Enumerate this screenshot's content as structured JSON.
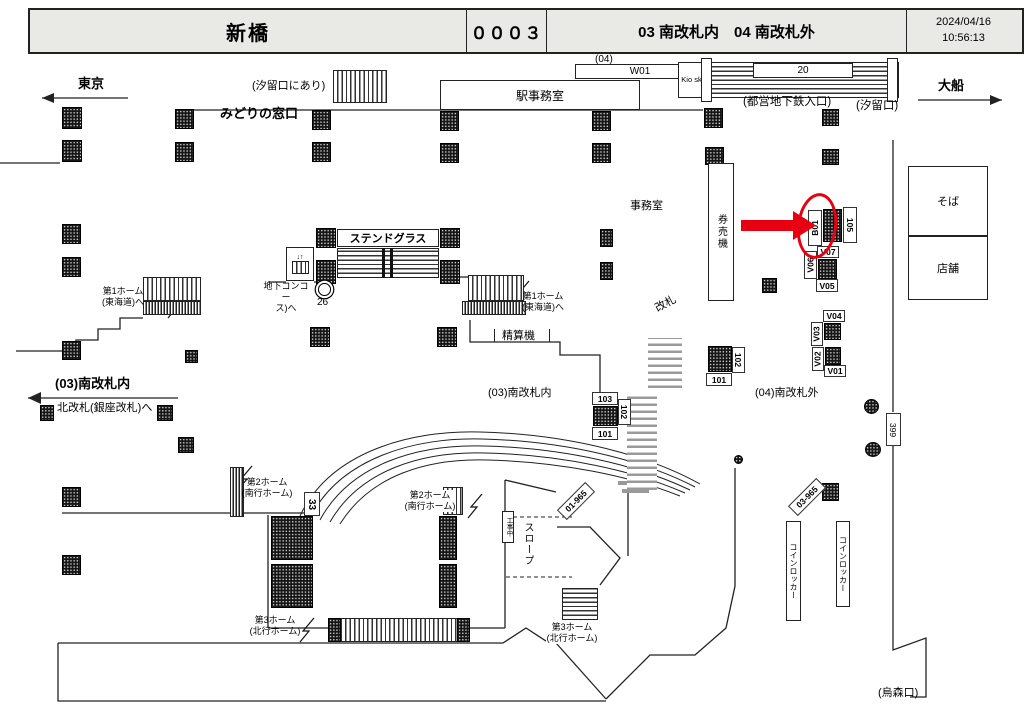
{
  "header": {
    "station": "新橋",
    "board_no": "０００３",
    "location": "03 南改札内　04 南改札外",
    "date": "2024/04/16",
    "time": "10:56:13"
  },
  "directions": {
    "west": "東京",
    "east": "大船"
  },
  "top": {
    "shiodome_note": "(汐留口にあり)",
    "midori": "みどりの窓口",
    "w01_level": "(04)",
    "w01": "W01",
    "station_office": "駅事務室",
    "kiosk": "Kio sk",
    "stair_no": "20",
    "subway_entrance": "(都営地下鉄入口)",
    "shiodome_exit": "(汐留口)"
  },
  "shops": {
    "soba": "そば",
    "tenpo": "店舗"
  },
  "concourse": {
    "office": "事務室",
    "ticket_machines": "券売機",
    "stained_glass": "ステンドグラス",
    "underground1": "地下コンコー",
    "underground2": "ス)へ",
    "elevator_no": "26",
    "gate": "改札",
    "fare_adjust": "精算機",
    "inside_south": "(03)南改札内",
    "to_north_gate": "北改札(銀座改札)へ",
    "outside_south": "(04)南改札外"
  },
  "platforms": {
    "p1": "第1ホーム",
    "p1_line": "(東海道)へ",
    "p2": "第2ホーム",
    "p2_line": "(南行ホーム)",
    "p3": "第3ホーム",
    "p3_line": "(北行ホーム)",
    "stair33": "33",
    "slope": "スロープ",
    "construction": "工事中",
    "ramp_label": "01-965",
    "pillar_label": "03-965",
    "corridor_label": "399"
  },
  "exits": {
    "karasumori": "(烏森口)"
  },
  "lockers": {
    "label": "コインロッカー"
  },
  "media": {
    "highlight": "B01",
    "l105": "105",
    "v07": "V07",
    "v06": "V06",
    "v05": "V05",
    "v04": "V04",
    "v03": "V03",
    "v02": "V02",
    "v01": "V01",
    "c103": "103",
    "c102": "102",
    "c101": "101",
    "g102": "102",
    "g101": "101"
  },
  "colors": {
    "highlight": "#e60012",
    "wall": "#222222",
    "header_bg": "#e9e9e6"
  }
}
